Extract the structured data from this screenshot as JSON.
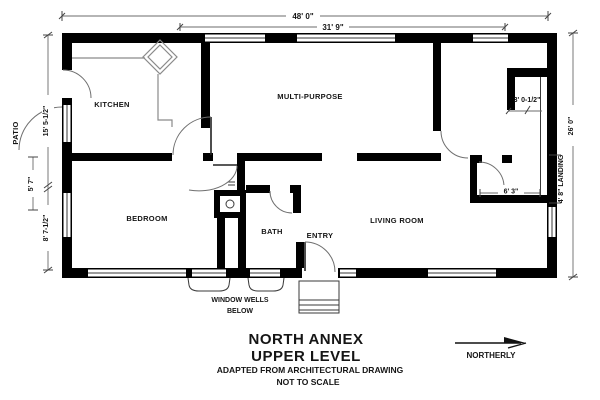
{
  "title": {
    "line1": "NORTH ANNEX",
    "line2": "UPPER LEVEL",
    "note1": "ADAPTED FROM ARCHITECTURAL DRAWING",
    "note2": "NOT TO SCALE"
  },
  "compass": {
    "label": "NORTHERLY"
  },
  "rooms": {
    "kitchen": "KITCHEN",
    "multi_purpose": "MULTI-PURPOSE",
    "bedroom": "BEDROOM",
    "bath": "BATH",
    "entry": "ENTRY",
    "living_room": "LIVING ROOM",
    "patio": "PATIO",
    "landing": "4' 8\" LANDING"
  },
  "dimensions": {
    "overall_width": "48' 0\"",
    "interior_width": "31' 9\"",
    "overall_depth": "26' 0\"",
    "kitchen_side": "15' 5-1/2\"",
    "patio_span": "5' 7\"",
    "bedroom_side": "8' 7-1/2\"",
    "stair_closet": "3' 0-1/2\"",
    "landing_width": "6' 3\""
  },
  "notes": {
    "window_wells": "WINDOW WELLS",
    "below": "BELOW"
  },
  "colors": {
    "wall": "#000000",
    "dimension_line": "#6b6b6b",
    "text": "#151515",
    "background": "#ffffff"
  }
}
